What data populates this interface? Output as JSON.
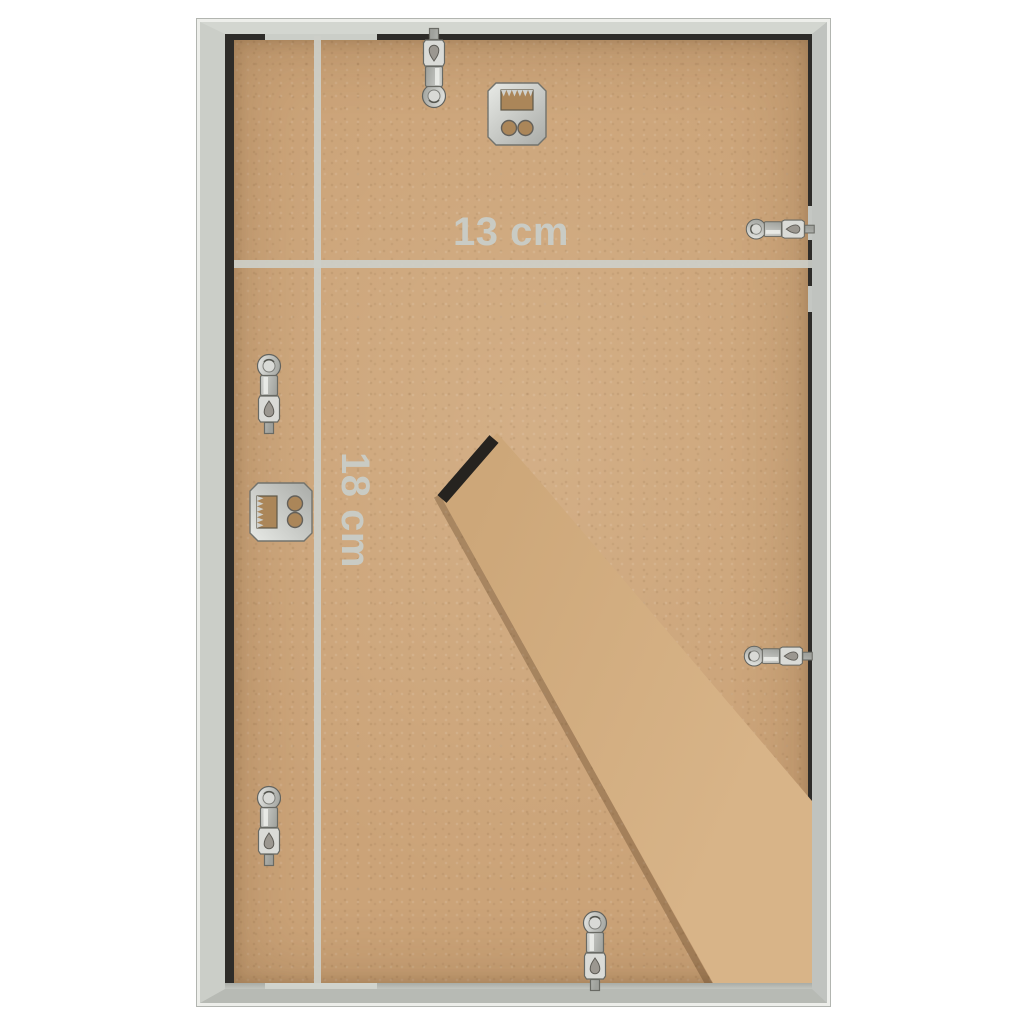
{
  "scene": {
    "subject": "Back of a photo frame with fold-out stand and mounting hardware",
    "background_color": "#ffffff"
  },
  "annotations": {
    "width_label": "13 cm",
    "height_label": "18 cm",
    "line_color": "#cdcfc9",
    "text_color": "#c9cbc4"
  },
  "frame": {
    "face_color": "#c9ccc8",
    "bevel_color": "#edeeea",
    "shadow_gap_color": "#2e2c29",
    "lip_color": "#b9bcb6"
  },
  "backboard": {
    "color": "#cba378"
  },
  "stand": {
    "color": "#d3ae84",
    "hinge_color": "#26231f"
  },
  "hardware": {
    "metal_color": "#cfd1cd",
    "items": [
      {
        "name": "swivel-clip-top"
      },
      {
        "name": "sawtooth-hanger-top"
      },
      {
        "name": "swivel-clip-right-upper"
      },
      {
        "name": "swivel-clip-left-upper"
      },
      {
        "name": "sawtooth-hanger-left"
      },
      {
        "name": "swivel-clip-right-lower"
      },
      {
        "name": "swivel-clip-left-lower"
      },
      {
        "name": "swivel-clip-bottom"
      }
    ]
  }
}
